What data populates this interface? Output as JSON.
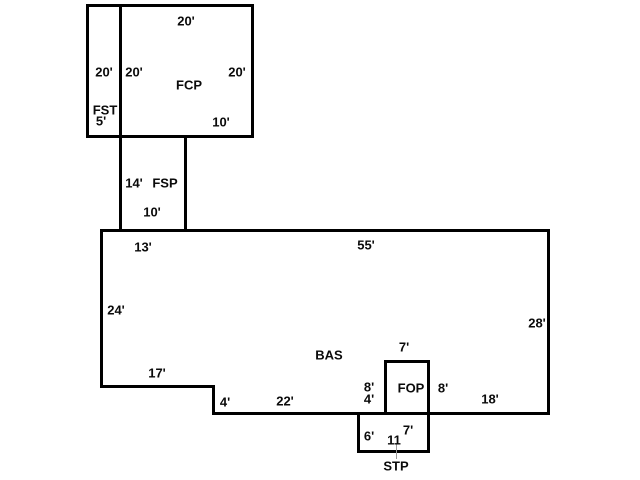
{
  "colors": {
    "background": "#ffffff",
    "line": "#000000",
    "text": "#0b0b0b",
    "leader_line": "#999999"
  },
  "fcp": {
    "label": "FCP",
    "dim_top": "20'",
    "dim_inner_left": "20'",
    "dim_right": "20'",
    "dim_bottom": "10'"
  },
  "fst": {
    "label": "FST",
    "dim_side": "20'",
    "dim_bottom": "5'"
  },
  "fsp": {
    "label": "FSP",
    "dim_width": "14'",
    "dim_bottom": "10'"
  },
  "bas": {
    "label": "BAS",
    "dim_top_left": "13'",
    "dim_top": "55'",
    "dim_left": "24'",
    "dim_right": "28'",
    "dim_notch_bottom": "17'",
    "dim_step": "4'",
    "dim_bottom_mid": "22'",
    "dim_bottom_right": "18'"
  },
  "fop": {
    "label": "FOP",
    "dim_top": "7'",
    "dim_left_upper": "8'",
    "dim_left_lower": "4'",
    "dim_right": "8'"
  },
  "stp": {
    "label": "STP",
    "dim_left": "6'",
    "dim_inner": "7'",
    "dim_bottom": "11"
  }
}
